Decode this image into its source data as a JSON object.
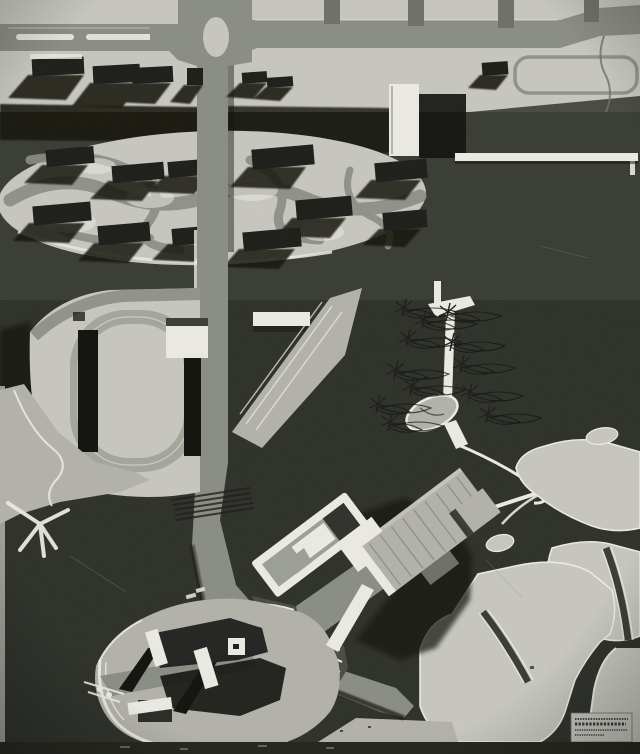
{
  "scene": {
    "description": "Black-and-white aerial photograph of an architectural site model: ring roads and housing slabs at top, an elliptical terrace of slab blocks, a stadium with running track at left, a central spine road, a footpath park with wire model trees, a large stepped building complex, harbor-like islands at lower right and a small tower-cluster island at lower left, with a tiny illegible architect plaque in the bottom-right corner.",
    "features": [
      "top ring road with roundabout",
      "housing slab blocks with cast shadows",
      "elliptical terrace with slab buildings",
      "stadium with running track and stands",
      "central spine road",
      "footpath with model trees",
      "stepped cluster building complex",
      "star road intersection with contour terraces",
      "harbor islands and channels",
      "tower-cluster island",
      "architect plaque (text illegible)"
    ]
  },
  "plaque": {
    "legible": false,
    "lines": 4
  },
  "palette": {
    "bg": "#3a3d36",
    "bgDeep": "#24261f",
    "terrain": "#c6c6bf",
    "terrainDim": "#b2b2aa",
    "white": "#eae9e2",
    "road": "#8a8d84",
    "roadDark": "#6e7168",
    "slab": "#1e1f1b",
    "shadow": "#131410",
    "track": "#a3a69b",
    "midGray": "#9c9f95",
    "contourBase": "#4a4d45"
  }
}
